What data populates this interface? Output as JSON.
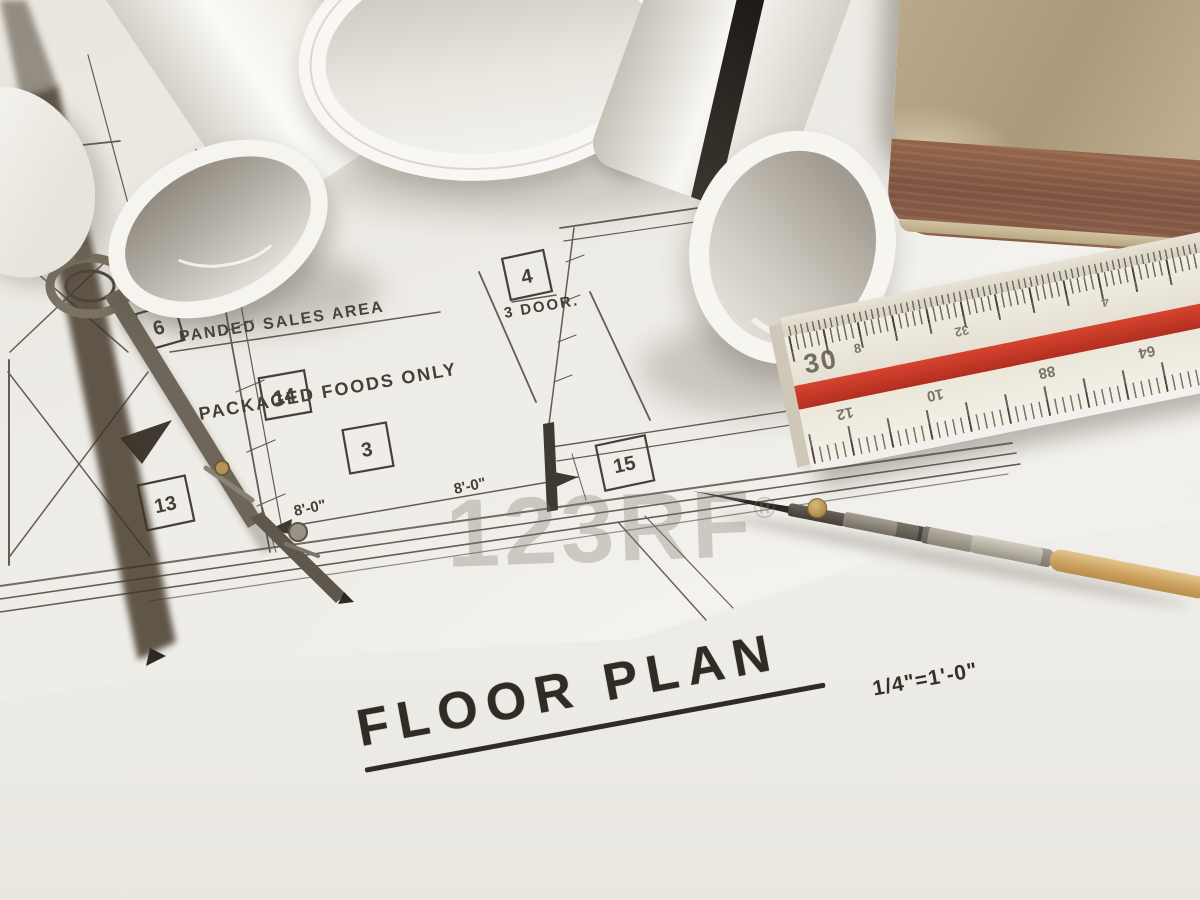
{
  "photo_subject": "Rolled architectural blueprints with drafting compass, triangular scale ruler, ruling pen and an old book lying on a floor plan drawing",
  "title_block": {
    "title": "FLOOR PLAN",
    "scale_note": "1/4\"=1'-0\""
  },
  "blueprint": {
    "labels": {
      "sales_area": "PANDED SALES AREA",
      "foods_only": "PACKAGED FOODS ONLY",
      "door": "3 DOOR.",
      "dim_a": "8'-0\"",
      "dim_b": "8'-0\"",
      "vr": "VR"
    },
    "keynotes": {
      "k18": "18",
      "k6": "6",
      "k14": "14",
      "k3": "3",
      "k13": "13",
      "k15": "15",
      "k4": "4"
    }
  },
  "ruler": {
    "scale_label": "30",
    "fraction": "8",
    "top_numbers": [
      "32",
      "4"
    ],
    "bottom_numbers": [
      "12",
      "10",
      "88",
      "64"
    ]
  },
  "watermark": {
    "text": "123RF",
    "registered": "®"
  },
  "colors": {
    "paper": "#efede8",
    "red_stripe": "#d0392a",
    "book_cover": "#b7a284",
    "book_edge": "#8d5c45",
    "ink": "#45403a"
  }
}
